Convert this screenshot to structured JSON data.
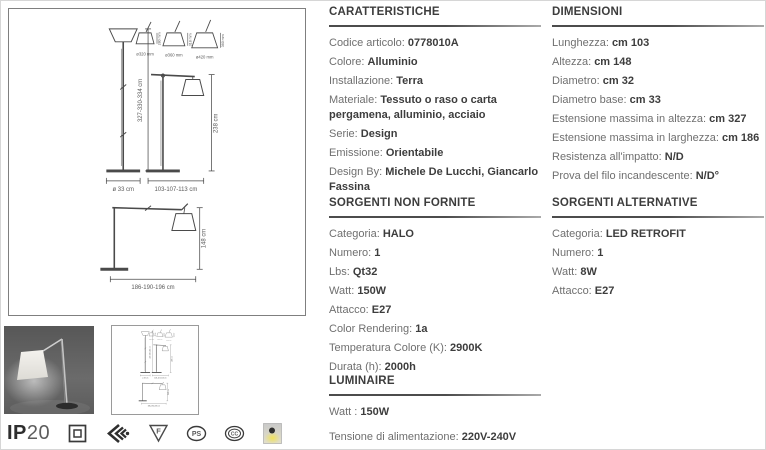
{
  "palette": {
    "header_text": "#3d3d3d",
    "label_text": "#6f6f6f",
    "drawing_line": "#4a4a4a",
    "icon_yellow": "#f1e254"
  },
  "drawing": {
    "tall_height": "327-330-334 cm",
    "tall_base": "ø 33 cm",
    "mid_height": "238 cm",
    "mid_width": "103-107-113 cm",
    "ext_height": "148 cm",
    "ext_width": "186-190-196 cm",
    "shade1_d": "ø320 mm",
    "shade2_d": "ø360 mm",
    "shade3_d": "ø420 mm",
    "shade1_h": "280 mm",
    "shade2_h": "318 mm",
    "shade3_h": "360 mm"
  },
  "sections": {
    "caratteristiche": {
      "title": "CARATTERISTICHE",
      "rows": [
        {
          "label": "Codice articolo:",
          "value": "0778010A"
        },
        {
          "label": "Colore:",
          "value": "Alluminio"
        },
        {
          "label": "Installazione:",
          "value": "Terra"
        },
        {
          "label": "Materiale:",
          "value": "Tessuto o raso o carta pergamena, alluminio, acciaio"
        },
        {
          "label": "Serie:",
          "value": "Design"
        },
        {
          "label": "Emissione:",
          "value": "Orientabile"
        },
        {
          "label": "Design By:",
          "value": "Michele De Lucchi, Giancarlo Fassina"
        }
      ]
    },
    "dimensioni": {
      "title": "DIMENSIONI",
      "rows": [
        {
          "label": "Lunghezza:",
          "value": "cm 103"
        },
        {
          "label": "Altezza:",
          "value": "cm 148"
        },
        {
          "label": "Diametro:",
          "value": "cm 32"
        },
        {
          "label": "Diametro base:",
          "value": "cm 33"
        },
        {
          "label": "Estensione massima in altezza:",
          "value": "cm 327"
        },
        {
          "label": "Estensione massima in larghezza:",
          "value": "cm 186"
        },
        {
          "label": "Resistenza all'impatto:",
          "value": "N/D"
        },
        {
          "label": "Prova del filo incandescente:",
          "value": "N/D°"
        }
      ]
    },
    "sorgenti_non_fornite": {
      "title": "SORGENTI NON FORNITE",
      "rows": [
        {
          "label": "Categoria:",
          "value": "HALO"
        },
        {
          "label": "Numero:",
          "value": "1"
        },
        {
          "label": "Lbs:",
          "value": "Qt32"
        },
        {
          "label": "Watt:",
          "value": "150W"
        },
        {
          "label": "Attacco:",
          "value": "E27"
        },
        {
          "label": "Color Rendering:",
          "value": "1a"
        },
        {
          "label": "Temperatura Colore (K):",
          "value": "2900K"
        },
        {
          "label": "Durata (h):",
          "value": "2000h"
        }
      ]
    },
    "sorgenti_alternative": {
      "title": "SORGENTI ALTERNATIVE",
      "rows": [
        {
          "label": "Categoria:",
          "value": "LED RETROFIT"
        },
        {
          "label": "Numero:",
          "value": "1"
        },
        {
          "label": "Watt:",
          "value": "8W"
        },
        {
          "label": "Attacco:",
          "value": "E27"
        }
      ]
    },
    "luminaire": {
      "title": "LUMINAIRE",
      "rows": [
        {
          "label": "Watt :",
          "value": "150W"
        },
        {
          "label": "Tensione di alimentazione:",
          "value": "220V-240V"
        }
      ]
    }
  },
  "footer": {
    "ip_bold": "IP",
    "ip_light": "20",
    "f_mark_letter": "F",
    "pse_mark_letters": "PS",
    "ccc_mark_letters": "CC"
  }
}
